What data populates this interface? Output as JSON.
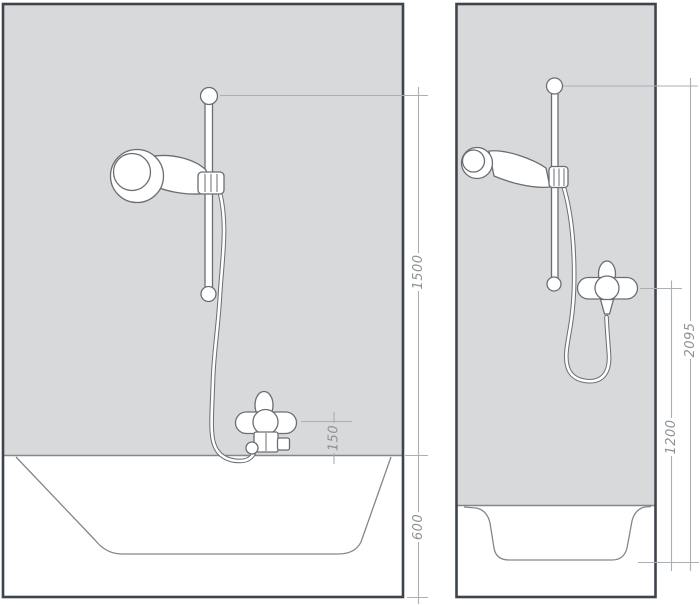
{
  "diagram": {
    "kind": "shower-set-installation-drawing",
    "figures": {
      "left": {
        "name": "bathtub-installation",
        "dimensions": {
          "rail_top_above_rim": {
            "label": "1500"
          },
          "mixer_above_rim": {
            "label": "150"
          },
          "tub_height": {
            "label": "600"
          }
        }
      },
      "right": {
        "name": "shower-tray-installation",
        "dimensions": {
          "rail_top_height": {
            "label": "2095"
          },
          "mixer_height": {
            "label": "1200"
          }
        }
      }
    }
  },
  "colors": {
    "background": "#ffffff",
    "wall_fill": "#d8d9db",
    "frame_stroke": "#3e444c",
    "rim_stroke": "#83878c",
    "fixture_stroke": "#6a6e73",
    "dimension_line": "#aaafb4",
    "dimension_text": "#8d9296"
  }
}
